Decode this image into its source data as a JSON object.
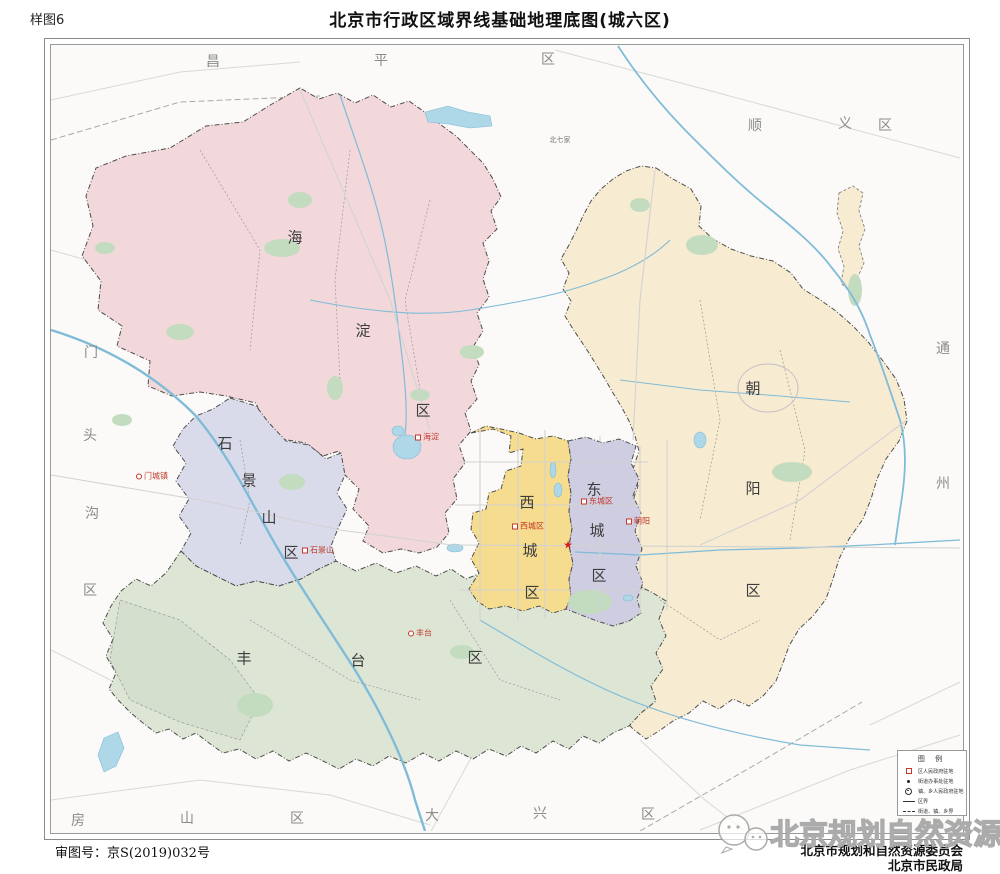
{
  "page": {
    "sample_label": "样图6",
    "title": "北京市行政区域界线基础地理底图(城六区)"
  },
  "footer": {
    "approval": "审图号：京S(2019)032号",
    "org_line1": "北京市规划和自然资源委员会",
    "org_line2": "北京市民政局",
    "watermark": "北京规划自然资源"
  },
  "icons": {
    "star": "★"
  },
  "colors": {
    "haidian": "#f2d8db",
    "shijingshan": "#d9dbeb",
    "fengtai": "#dde6d5",
    "xicheng": "#f6dc8e",
    "dongcheng": "#cfcde2",
    "chaoyang": "#f7ebd1",
    "park": "#c3dcbf",
    "water": "#aed7e8",
    "river": "#80bcd8",
    "seat_red": "#c0392b"
  },
  "districts": [
    {
      "name": "海淀区",
      "chars": [
        "海",
        "淀",
        "区"
      ],
      "fill": "#f2d8db",
      "seat": "海淀"
    },
    {
      "name": "石景山区",
      "chars": [
        "石",
        "景",
        "山",
        "区"
      ],
      "fill": "#d9dbeb",
      "seat": "石景山"
    },
    {
      "name": "丰台区",
      "chars": [
        "丰",
        "台",
        "区"
      ],
      "fill": "#dde6d5",
      "seat": "丰台"
    },
    {
      "name": "西城区",
      "chars": [
        "西",
        "城",
        "区"
      ],
      "fill": "#f6dc8e",
      "seat": "西城区"
    },
    {
      "name": "东城区",
      "chars": [
        "东",
        "城",
        "区"
      ],
      "fill": "#cfcde2",
      "seat": "东城区"
    },
    {
      "name": "朝阳区",
      "chars": [
        "朝",
        "阳",
        "区"
      ],
      "fill": "#f7ebd1",
      "seat": "朝阳"
    }
  ],
  "neighbors": [
    {
      "name": "昌平区",
      "chars": [
        "昌",
        "平",
        "区"
      ]
    },
    {
      "name": "顺义区",
      "chars": [
        "顺",
        "义",
        "区"
      ]
    },
    {
      "name": "通州区",
      "chars": [
        "通",
        "州"
      ]
    },
    {
      "name": "门头沟区",
      "chars": [
        "门",
        "头",
        "沟",
        "区"
      ]
    },
    {
      "name": "房山区",
      "chars": [
        "房",
        "山",
        "区"
      ]
    },
    {
      "name": "大兴区",
      "chars": [
        "大",
        "兴",
        "区"
      ]
    }
  ],
  "labels": {
    "mencheng": "门城镇",
    "beiqijia": "北七家"
  },
  "legend": {
    "title": "图  例",
    "items": [
      {
        "symbol": "red-square",
        "label": "区人民政府驻地"
      },
      {
        "symbol": "black-dot",
        "label": "街道办事处驻地"
      },
      {
        "symbol": "double-circle",
        "label": "镇、乡人民政府驻地"
      },
      {
        "symbol": "solid-line",
        "label": "区界"
      },
      {
        "symbol": "dash-line",
        "label": "街道、镇、乡界"
      }
    ]
  }
}
